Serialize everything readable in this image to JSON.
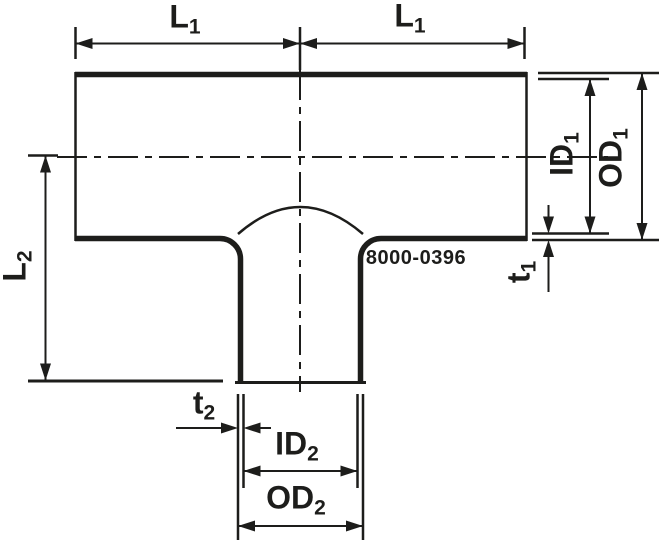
{
  "drawing": {
    "part_number": "8000-0396",
    "colors": {
      "line": "#1d1d1b",
      "background": "#ffffff"
    }
  },
  "labels": {
    "l1_left": {
      "base": "L",
      "sub": "1"
    },
    "l1_right": {
      "base": "L",
      "sub": "1"
    },
    "l2": {
      "base": "L",
      "sub": "2"
    },
    "id1": {
      "base": "ID",
      "sub": "1"
    },
    "od1": {
      "base": "OD",
      "sub": "1"
    },
    "t1": {
      "base": "t",
      "sub": "1"
    },
    "t2": {
      "base": "t",
      "sub": "2"
    },
    "id2": {
      "base": "ID",
      "sub": "2"
    },
    "od2": {
      "base": "OD",
      "sub": "2"
    }
  }
}
